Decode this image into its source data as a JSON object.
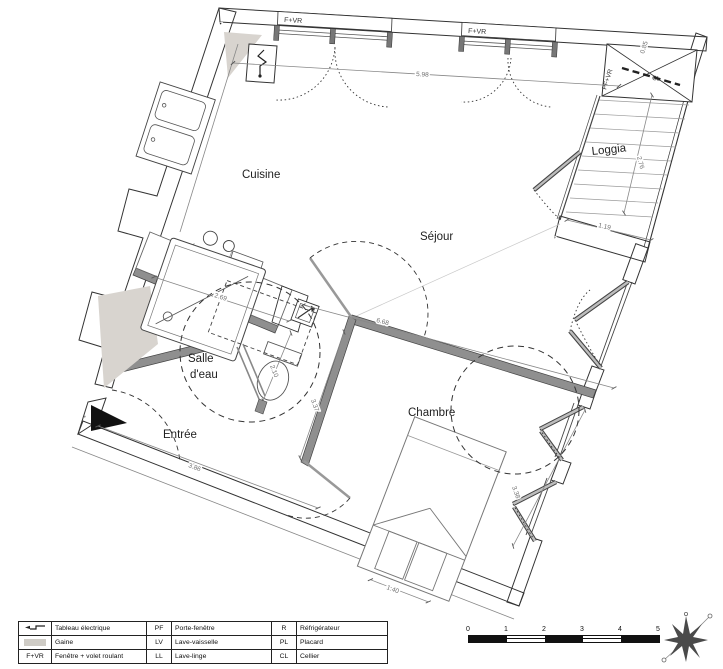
{
  "plan": {
    "rooms": {
      "cuisine": "Cuisine",
      "sejour": "Séjour",
      "loggia": "Loggia",
      "chambre": "Chambre",
      "entree": "Entrée",
      "salle_eau_1": "Salle",
      "salle_eau_2": "d'eau",
      "cellier": "CL"
    },
    "tags": {
      "fvr1": "F+VR",
      "fvr2": "F+VR",
      "pfvr": "PF+VR",
      "four": "F",
      "lave_linge": "LL"
    },
    "dims": {
      "d598": "5.98",
      "d668": "6.68",
      "d269": "2.69",
      "d210": "2.10",
      "d337": "3.37",
      "d386": "3.86",
      "d140": "1.40",
      "d338": "3.38",
      "d276": "2.76",
      "d119": "1.19",
      "d085": "0.85"
    }
  },
  "legend": {
    "rows": [
      {
        "c1": "",
        "c2": "Tableau électrique",
        "c3": "PF",
        "c4": "Porte-fenêtre",
        "c5": "R",
        "c6": "Réfrigérateur"
      },
      {
        "c1": "",
        "c2": "Gaine",
        "c3": "LV",
        "c4": "Lave-vaisselle",
        "c5": "PL",
        "c6": "Placard"
      },
      {
        "c1": "F+VR",
        "c2": "Fenêtre + volet roulant",
        "c3": "LL",
        "c4": "Lave-linge",
        "c5": "CL",
        "c6": "Cellier"
      }
    ]
  },
  "scale_bar": {
    "ticks": [
      "0",
      "1",
      "2",
      "3",
      "4",
      "5"
    ]
  },
  "colors": {
    "wall_fill": "#9a9a9a",
    "partition": "#8f8f8f",
    "gaine": "#d8d4cf",
    "line": "#333333",
    "dim_text": "#6e6e6e"
  }
}
